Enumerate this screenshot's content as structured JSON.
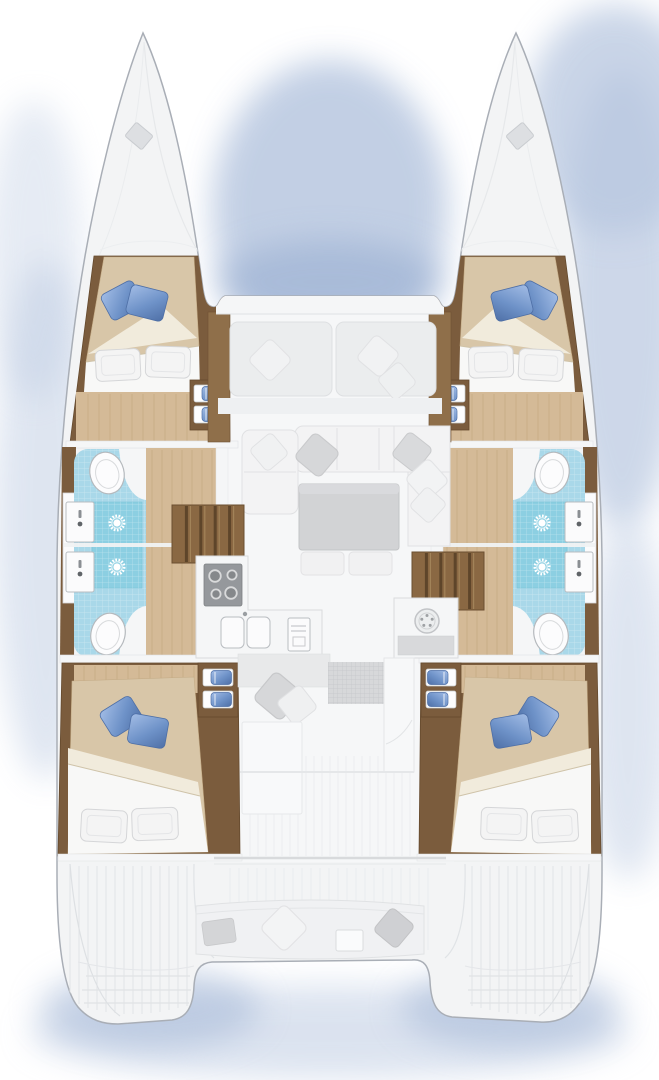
{
  "page": {
    "title": "Catamaran yacht floor plan — overhead deck view"
  },
  "colors": {
    "bg": "#ffffff",
    "shadow-blue": "#b8c7e0",
    "shadow-deep": "#9fb3d4",
    "hull-white": "#f3f4f5",
    "hull-stroke": "#a9aeb6",
    "deck-line": "#e2e4e7",
    "trim-white": "#f5f6f7",
    "wood-dark": "#7b5c3d",
    "wood-mid": "#8f6f4a",
    "wood-edge": "#654a2e",
    "floor-tan": "#d4ba97",
    "floor-line": "#c0a278",
    "blanket-tan": "#d8c6a8",
    "sheet-white": "#f8f8f7",
    "fold-cream": "#f1ebdc",
    "pillow-white": "#f4f4f4",
    "pillow-blue": "#7296cc",
    "pillow-blue-dark": "#4e6fa6",
    "pillow-blue-light": "#a3bde6",
    "tile-blue": "#a9d8e9",
    "tile-shower": "#8ccfe2",
    "fixture-white": "#fbfbfc",
    "fixture-stroke": "#b9bdc1",
    "sofa-white": "#f3f3f4",
    "sofa-stroke": "#e0e1e3",
    "cushion-gray": "#d6d7d9",
    "bench-gray": "#ebedee",
    "table-gray": "#d2d3d5",
    "stove-gray": "#95989c",
    "stair-wood": "#8a6843",
    "stair-line": "#5e452a",
    "grid-gray": "#d7d8da"
  },
  "vessel": {
    "type": "catamaran",
    "view": "top-down floor plan",
    "hulls": 2,
    "double_berth_cabins": 4,
    "bathrooms": 4,
    "showers": 4,
    "toilets": 4,
    "wash_basins": 4,
    "areas": [
      "port-bow-deck",
      "starboard-bow-deck",
      "forward-cockpit-seating",
      "saloon-sofa",
      "saloon-table",
      "galley-stove",
      "galley-double-sink",
      "port-forward-cabin",
      "port-aft-cabin",
      "starboard-forward-cabin",
      "starboard-aft-cabin",
      "hull-companionway-stairs",
      "aft-cockpit-bench",
      "swim-platforms"
    ]
  }
}
